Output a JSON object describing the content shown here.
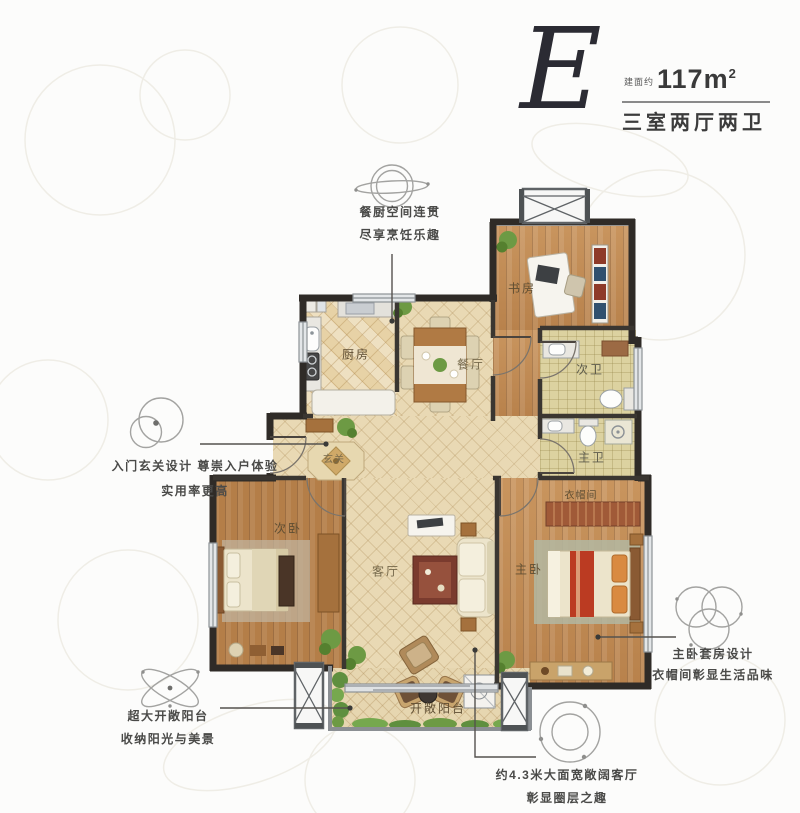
{
  "header": {
    "plan_letter": "E",
    "area_prefix": "建面约",
    "area_value": "117m",
    "area_sup": "2",
    "layout_desc": "三室两厅两卫"
  },
  "rooms": {
    "kitchen": "厨房",
    "dining": "餐厅",
    "study": "书房",
    "bath_second": "次卫",
    "bath_master": "主卫",
    "cloakroom": "衣帽间",
    "foyer": "玄关",
    "bedroom_second": "次卧",
    "living": "客厅",
    "bedroom_master": "主卧",
    "balcony": "开敞阳台"
  },
  "annotations": {
    "kitchen_dining": {
      "icon": "saturn-rings-icon",
      "line1": "餐厨空间连贯",
      "line2": "尽享烹饪乐趣"
    },
    "foyer": {
      "icon": "double-circle-icon",
      "line1": "入门玄关设计  尊崇入户体验",
      "line2": "实用率更高"
    },
    "balcony": {
      "icon": "atom-orbit-icon",
      "line1": "超大开敞阳台",
      "line2": "收纳阳光与美景"
    },
    "living": {
      "icon": "dotted-circle-icon",
      "line1": "约4.3米大面宽敞阔客厅",
      "line2": "彰显圈层之趣"
    },
    "master_suite": {
      "icon": "triple-circle-icon",
      "line1": "主卧套房设计",
      "line2": "衣帽间彰显生活品味"
    }
  },
  "colors": {
    "wall": "#2f2b27",
    "wood_floor": "#c18a52",
    "tile_floor": "#e9d9b4",
    "bath_floor": "#dcd2a0",
    "accent_orange": "#bb3b22",
    "plant_green": "#5f8f3f",
    "annotation_text": "#4a4a48",
    "header_text": "#2b2b33"
  }
}
